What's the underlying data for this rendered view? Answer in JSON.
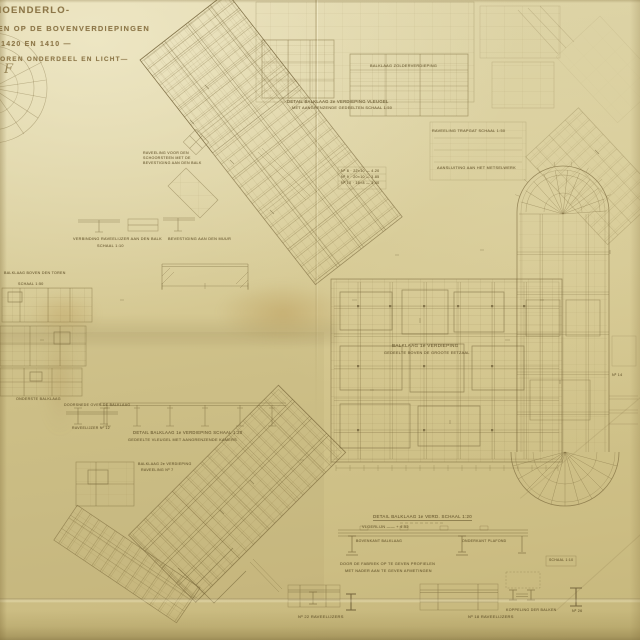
{
  "document": {
    "kind": "scanned architectural blueprint (balklagen / beam layout plan)",
    "paper_color": "#d8cc98",
    "ink_color": "#6f5d33"
  },
  "title_block": {
    "line1": "-HOENDERLO-",
    "line2": "AGEN OP DE BOVENVERDIEPINGEN",
    "line3": "Nº 1420 EN 1410 —",
    "line4": "DOOREN ONDERDEEL EN LICHT—",
    "mark": "F"
  },
  "captions": {
    "c1": "DETAIL BALKLAAG 2e VERDIEPING VLEUGEL",
    "c2": "MET AANGRENZENDE GEDEELTEN  SCHAAL 1:50",
    "c3": "BALKLAAG ZOLDERVERDIEPING",
    "c4": "RAVEELING TRAPGAT  SCHAAL 1:50",
    "c5a": "Nº 8 · 22×10 — 4.20",
    "c5b": "Nº 9 · 20×10 — 3.85",
    "c5c": "Nº 10 · 18×8 — 3.40",
    "c6": "AANSLUITING AAN HET METSELWERK",
    "c7": "BALKLAAG 1e VERDIEPING",
    "c8": "GEDEELTE BOVEN DE GROOTE EETZAAL",
    "c9": "RAVEELING VOOR DEN",
    "c10": "SCHOORSTEEN MET DE",
    "c11": "BEVESTIGING AAN DEN BALK",
    "c12": "VERBINDING RAVEELIJZER AAN DEN BALK",
    "c13": "SCHAAL 1:10",
    "c14": "BEVESTIGING AAN DEN MUUR",
    "c15": "DETAIL BALKLAAG 1e VERDIEPING  SCHAAL 1:20",
    "c16": "GEDEELTE VLEUGEL MET AANGRENZENDE KAMERS",
    "c17": "BALKLAAG BOVEN DEN TOREN",
    "c18": "SCHAAL 1:50",
    "c19": "ONDERSTE BALKLAAG",
    "c20": "DOORSNEDE OVER DE BALKLAAG",
    "c21": "RAVEELIJZER Nº 12",
    "c22": "BALKLAAG 2e VERDIEPING",
    "c23": "RAVEELING Nº 7",
    "c24": "DETAIL BALKLAAG 1e VERD.  SCHAAL 1:20",
    "c25": "VLOERLIJN ―― + 4.52",
    "c26": "BOVENKANT BALKLAAG",
    "c27": "ONDERKANT PLAFOND",
    "c28": "DOOR DE FABRIEK OP TE GEVEN PROFIELEN",
    "c29": "MET NADER AAN TE GEVEN AFMETINGEN",
    "c30": "Nº 22 RAVEELIJZERS",
    "c31": "Nº 18 RAVEELIJZERS",
    "c32": "KOPPELING DER BALKEN",
    "c33": "SCHAAL 1:10",
    "c34": "Nº 26",
    "c35": "Nº 14"
  }
}
